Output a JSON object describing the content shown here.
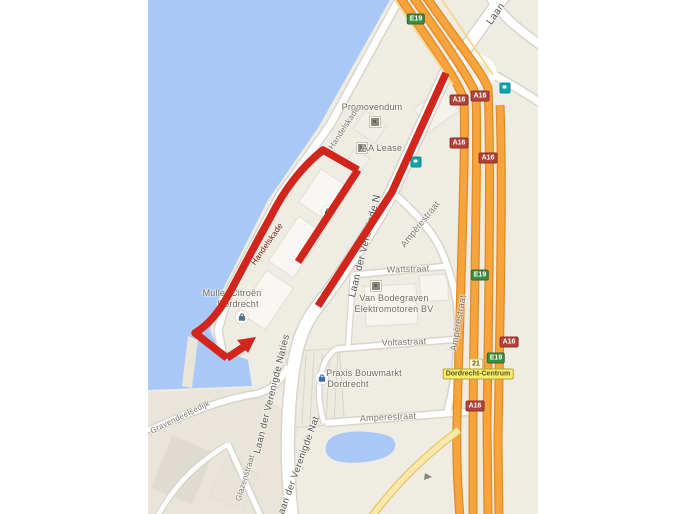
{
  "map": {
    "description": "Google-Maps style map of the Dordrecht harbour industrial area with a red hand-drawn route highlight",
    "labels": {
      "promovendum": "Promovendum",
      "aa_lease": "AA Lease",
      "handelskade_top": "Handelskade",
      "handelskade_on_route": "Handelskade",
      "muller_line1": "Muller Citroën",
      "muller_line2": "Dordrecht",
      "laan_mid": "Laan der Verenigde N",
      "amperestraat_ne": "Ampèrestraat",
      "wattstraat": "Wattstraat",
      "van_bodegraven_line1": "Van Bodegraven",
      "van_bodegraven_line2": "Elektromotoren BV",
      "voltastraat": "Voltastraat",
      "amperestraat_e": "Ampèrestraat",
      "praxis_line1": "Praxis Bouwmarkt",
      "praxis_line2": "Dordrecht",
      "amperestraat_s": "Amperestraat",
      "glazenstraat": "Glazenstraat",
      "gravendeelsedijk": "'s-Gravendeelsedijk",
      "laan_s1": "Laan der Verenigde Naties",
      "laan_s2": "Laan der Verenigde Nat",
      "laan_top": "Laan"
    },
    "badges": {
      "e19": "E19",
      "a16": "A16",
      "exit_21": "21",
      "dordrecht_centrum": "Dordrecht-Centrum"
    },
    "colors": {
      "water_blue": "#aac8f7",
      "land_beige": "#efece3",
      "motorway_orange": "#f7a43c",
      "ramp_yellow": "#f9e9a8",
      "route_red": "#d2261c",
      "badge_green": "#3d8e40",
      "badge_red": "#b2423a",
      "destination_yellow": "#f7ee6b"
    }
  }
}
